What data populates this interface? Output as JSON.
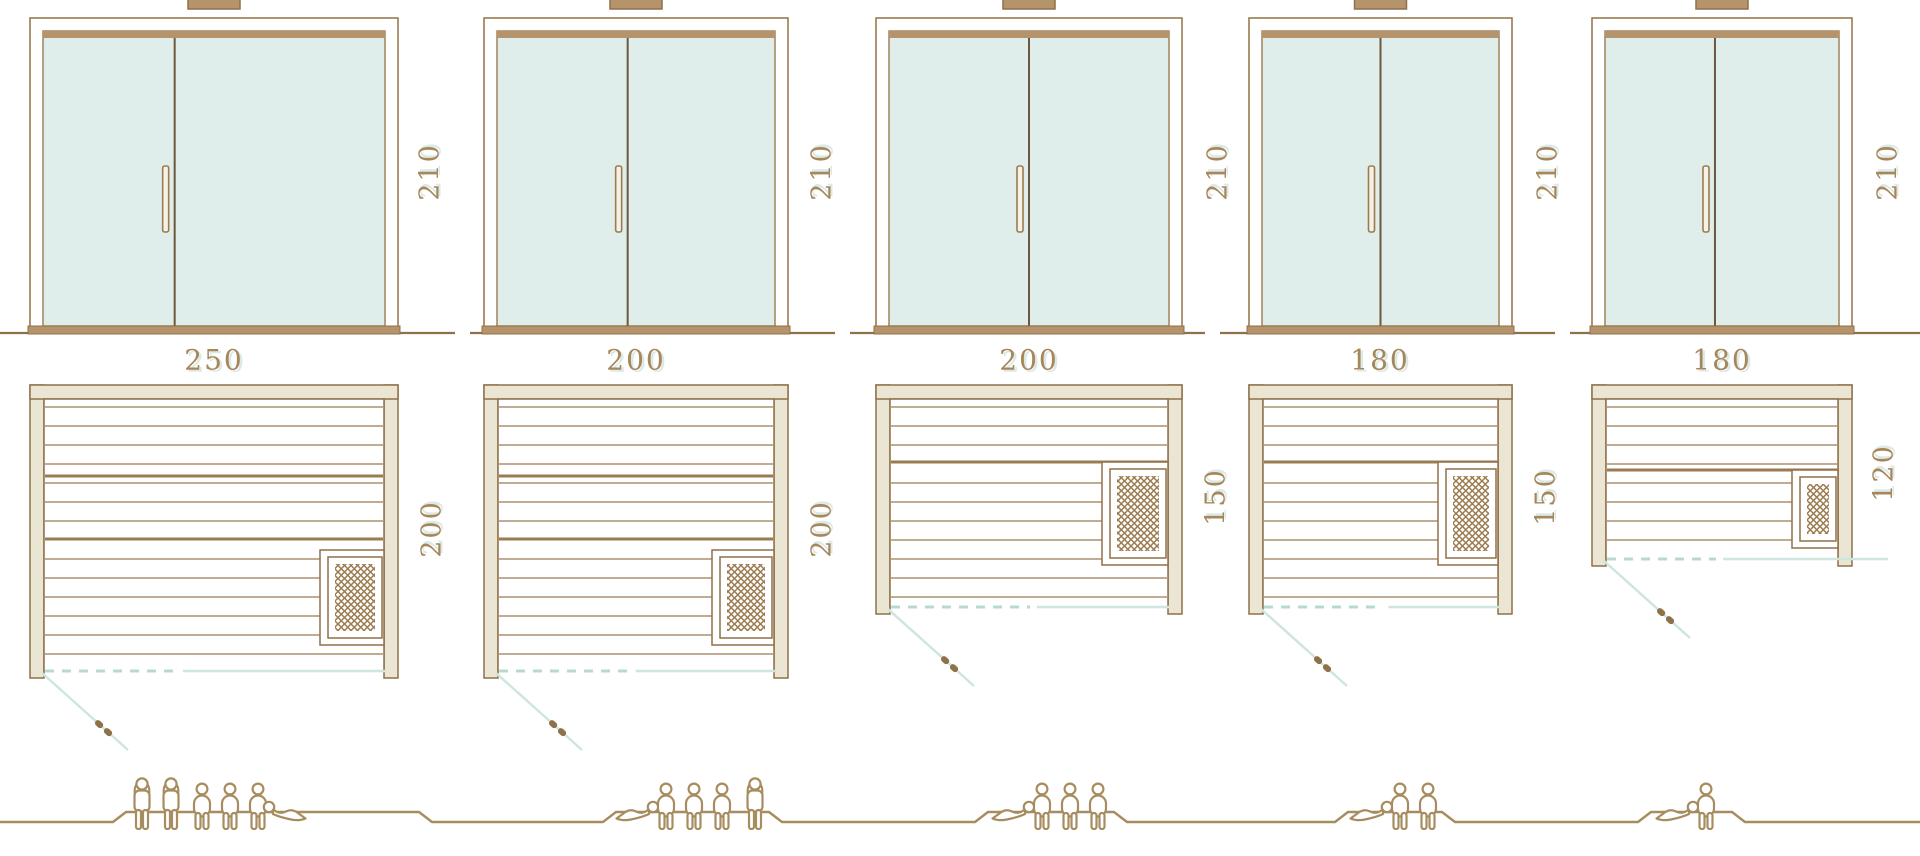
{
  "diagram": {
    "type": "sauna-size-comparison",
    "rows": [
      "front-elevation",
      "floor-plan",
      "capacity-figures"
    ]
  },
  "palette": {
    "outline_brown": "#8f7149",
    "line_brown": "#9b7b50",
    "tan_fill": "#b5936b",
    "cream_wall": "#eae6d3",
    "glass_fill": "#dfeeea",
    "teal_solid": "#cfe5e0",
    "teal_dash": "#b9d8d2",
    "label_color": "#a5875a",
    "people_color": "#a78c60",
    "divider_dark": "#6b583f"
  },
  "units": [
    {
      "id": "sauna-1",
      "width_label": "250",
      "depth_label": "200",
      "door_height_label": "210",
      "capacity": 6,
      "people": [
        "standing",
        "standing",
        "sitting",
        "sitting",
        "sitting",
        "lying-right"
      ],
      "heater_position": "bottom-right"
    },
    {
      "id": "sauna-2",
      "width_label": "200",
      "depth_label": "200",
      "door_height_label": "210",
      "capacity": 5,
      "people": [
        "lying-left",
        "sitting",
        "sitting",
        "sitting",
        "standing"
      ],
      "heater_position": "bottom-right"
    },
    {
      "id": "sauna-3",
      "width_label": "200",
      "depth_label": "150",
      "door_height_label": "210",
      "capacity": 4,
      "people": [
        "lying-left",
        "sitting",
        "sitting",
        "sitting"
      ],
      "heater_position": "middle-right"
    },
    {
      "id": "sauna-4",
      "width_label": "180",
      "depth_label": "150",
      "door_height_label": "210",
      "capacity": 3,
      "people": [
        "lying-left",
        "sitting",
        "sitting"
      ],
      "heater_position": "middle-right"
    },
    {
      "id": "sauna-5",
      "width_label": "180",
      "depth_label": "120",
      "door_height_label": "210",
      "capacity": 2,
      "people": [
        "lying-left",
        "sitting"
      ],
      "heater_position": "bottom-right"
    }
  ]
}
